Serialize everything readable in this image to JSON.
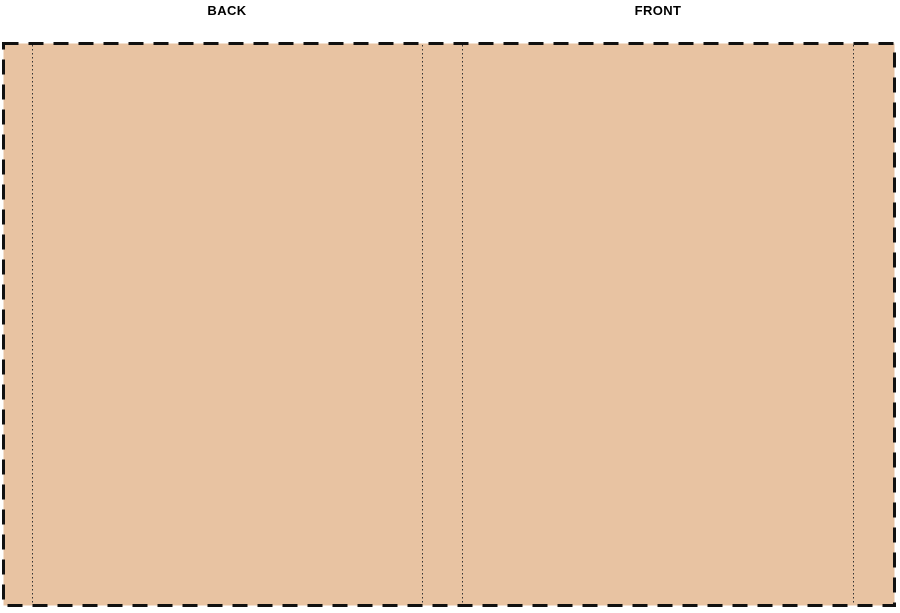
{
  "canvas": {
    "back_label": "BACK",
    "front_label": "FRONT"
  },
  "colors": {
    "page_background": "#ffffff",
    "cover_fill": "#e8c3a2",
    "trim_dash_border": "#111111",
    "guide_line": "#333333",
    "label_text": "#000000"
  }
}
